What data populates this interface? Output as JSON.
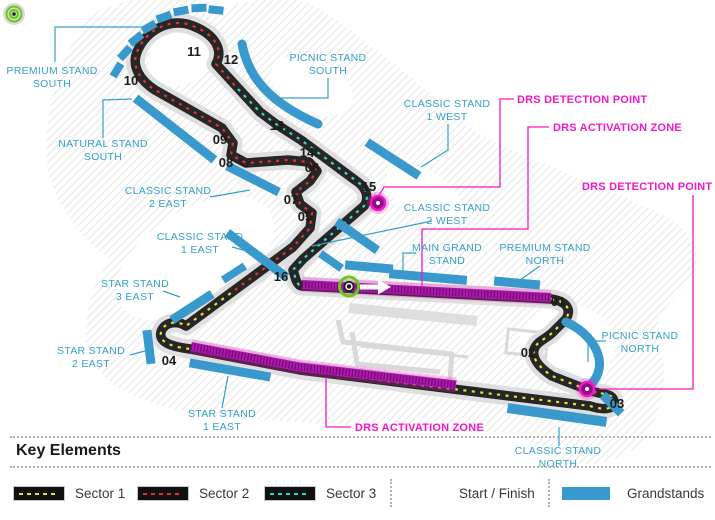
{
  "colors": {
    "stand-blue": "#3A99CC",
    "label-cyan": "#35A0C8",
    "drs-magenta": "#F218C8",
    "drs-band": "#AD17AE",
    "drs-band-hatch": "rgba(40,0,38,0.55)",
    "drs-glow": "rgba(242,24,200,0.25)",
    "sector1": "#E8E13A",
    "sector2": "#E8302E",
    "sector3": "#35D9C8",
    "track": "#262626",
    "track-halo": "#DFDFDF",
    "start-green": "#6CC818"
  },
  "map": {
    "corners": [
      "01",
      "02",
      "03",
      "04",
      "05",
      "06",
      "07",
      "08",
      "09",
      "10",
      "11",
      "12",
      "13",
      "14",
      "15",
      "16"
    ],
    "stands": [
      {
        "id": "premium-stand-south",
        "lines": [
          "PREMIUM STAND",
          "SOUTH"
        ]
      },
      {
        "id": "natural-stand-south",
        "lines": [
          "NATURAL STAND",
          "SOUTH"
        ]
      },
      {
        "id": "picnic-stand-south",
        "lines": [
          "PICNIC STAND",
          "SOUTH"
        ]
      },
      {
        "id": "classic-stand-1-west",
        "lines": [
          "CLASSIC STAND",
          "1 WEST"
        ]
      },
      {
        "id": "classic-stand-2-east",
        "lines": [
          "CLASSIC STAND",
          "2 EAST"
        ]
      },
      {
        "id": "classic-stand-1-east",
        "lines": [
          "CLASSIC STAND",
          "1 EAST"
        ]
      },
      {
        "id": "classic-stand-2-west",
        "lines": [
          "CLASSIC STAND",
          "2 WEST"
        ]
      },
      {
        "id": "star-stand-3-east",
        "lines": [
          "STAR STAND",
          "3 EAST"
        ]
      },
      {
        "id": "star-stand-2-east",
        "lines": [
          "STAR STAND",
          "2 EAST"
        ]
      },
      {
        "id": "star-stand-1-east",
        "lines": [
          "STAR STAND",
          "1 EAST"
        ]
      },
      {
        "id": "main-grand-stand",
        "lines": [
          "MAIN GRAND",
          "STAND"
        ]
      },
      {
        "id": "premium-stand-north",
        "lines": [
          "PREMIUM STAND",
          "NORTH"
        ]
      },
      {
        "id": "picnic-stand-north",
        "lines": [
          "PICNIC STAND",
          "NORTH"
        ]
      },
      {
        "id": "classic-stand-north",
        "lines": [
          "CLASSIC STAND",
          "NORTH"
        ]
      }
    ],
    "drs": {
      "detection_label": "DRS DETECTION POINT",
      "activation_label": "DRS ACTIVATION ZONE"
    }
  },
  "legend": {
    "heading": "Key Elements",
    "items": [
      {
        "label": "Sector 1"
      },
      {
        "label": "Sector 2"
      },
      {
        "label": "Sector 3"
      },
      {
        "label": "Start / Finish"
      },
      {
        "label": "Grandstands"
      }
    ]
  }
}
